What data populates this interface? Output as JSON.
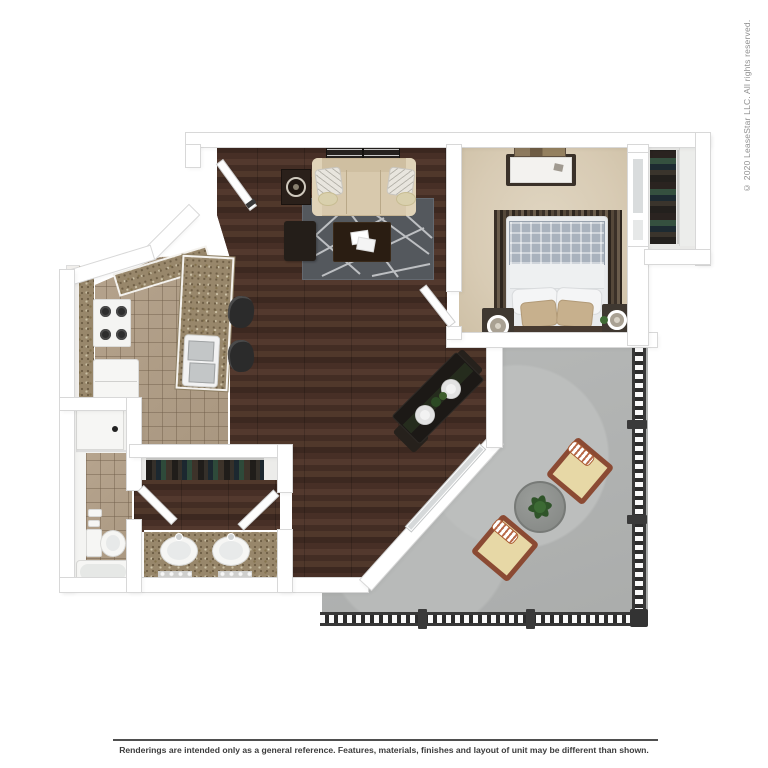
{
  "copyright": {
    "text": "© 2020 LeaseStar LLC. All rights reserved."
  },
  "disclaimer": {
    "text": "Renderings are intended only as a general reference. Features, materials, finishes and layout of unit may be different than shown."
  },
  "floorplan": {
    "type": "apartment-3d-top-view-rendering",
    "rooms": [
      "living-room",
      "bedroom",
      "walk-in-closet",
      "kitchen",
      "bathroom",
      "toilet-room",
      "laundry-closet",
      "patio"
    ],
    "furniture": [
      "sofa",
      "wall-shelves",
      "end-table",
      "ottoman",
      "coffee-table",
      "area-rug",
      "dining-table",
      "dining-chairs",
      "barstools",
      "breakfast-bar",
      "kitchen-sink",
      "stove",
      "refrigerator",
      "washer",
      "bed",
      "nightstands",
      "lamps",
      "dresser",
      "artwork",
      "hanging-clothes",
      "double-vanity",
      "toilet",
      "bathtub",
      "patio-table",
      "potted-plant",
      "patio-chairs",
      "railing"
    ],
    "palette": {
      "wood_floor": "#46302a",
      "kitchen_tile": "#b09e88",
      "bedroom_carpet": "#dbcfba",
      "patio_concrete": "#b2b4b3",
      "granite_counter": "#98876b",
      "wall": "#ffffff",
      "rug": "#54585d",
      "sofa": "#d8c9ad",
      "patio_chair_frame": "#8b4a33",
      "railing": "#2c2c2c"
    }
  }
}
